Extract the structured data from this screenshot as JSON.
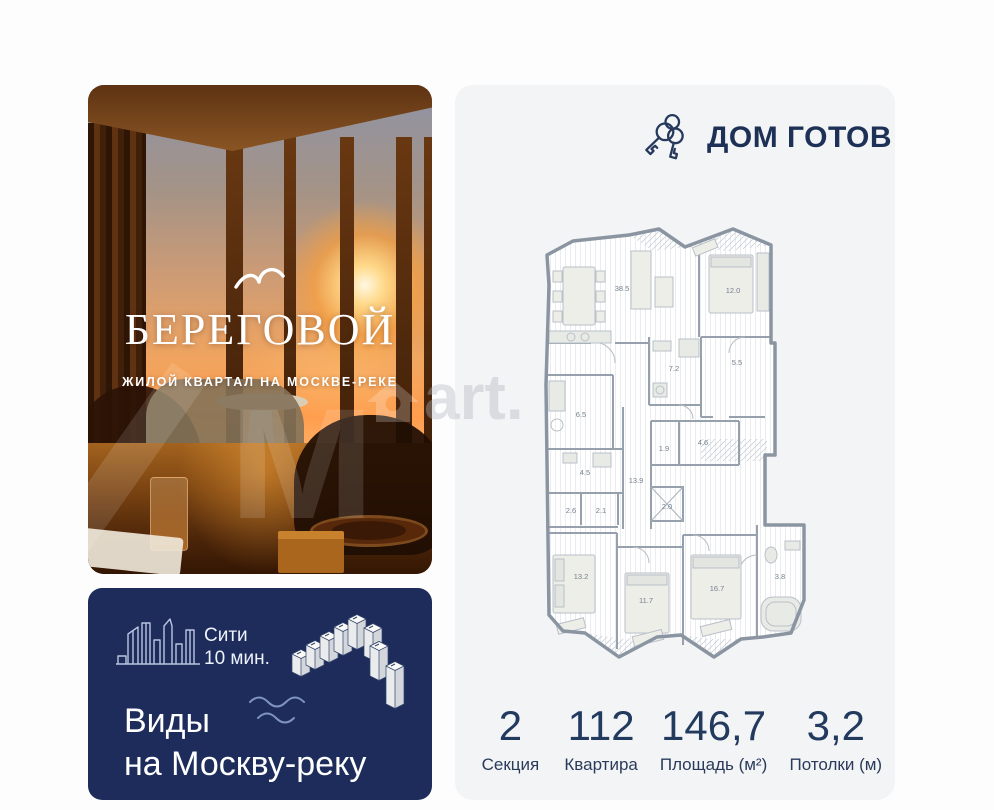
{
  "promo": {
    "brand": "БЕРЕГОВОЙ",
    "tagline": "ЖИЛОЙ КВАРТАЛ НА МОСКВЕ-РЕКЕ",
    "logo_icon": "seagull-icon",
    "scene": "sunset interior with panoramic windows over Moscow river"
  },
  "banner": {
    "background_color": "#1d2c5b",
    "transit_line1": "Сити",
    "transit_line2": "10 мин.",
    "title_line1": "Виды",
    "title_line2": "на Москву-реку",
    "icons": [
      "moscow-city-skyline-icon",
      "riverside-buildings-isometric-icon",
      "river-waves-icon"
    ]
  },
  "status": {
    "label": "ДОМ ГОТОВ",
    "icon": "keys-icon",
    "color": "#1d3156"
  },
  "floor_plan": {
    "type": "apartment-plan",
    "rooms": [
      {
        "name": "kitchen-living",
        "area": "38.5"
      },
      {
        "name": "bedroom-master",
        "area": "12.0"
      },
      {
        "name": "bathroom-1",
        "area": "7.2"
      },
      {
        "name": "hallway",
        "area": "5.5"
      },
      {
        "name": "utility",
        "area": "6.5"
      },
      {
        "name": "wardrobe",
        "area": "4.6"
      },
      {
        "name": "wc",
        "area": "1.9"
      },
      {
        "name": "bathroom-2",
        "area": "4.5"
      },
      {
        "name": "corridor",
        "area": "13.9"
      },
      {
        "name": "closet-1",
        "area": "2.6"
      },
      {
        "name": "closet-2",
        "area": "2.1"
      },
      {
        "name": "shaft-closet",
        "area": "2.0"
      },
      {
        "name": "bedroom-2",
        "area": "13.2"
      },
      {
        "name": "bedroom-3",
        "area": "11.7"
      },
      {
        "name": "bedroom-4",
        "area": "16.7"
      },
      {
        "name": "bathroom-3",
        "area": "3.8"
      }
    ]
  },
  "stats": [
    {
      "value": "2",
      "label": "Секция"
    },
    {
      "value": "112",
      "label": "Квартира"
    },
    {
      "value": "146,7",
      "label": "Площадь (м²)"
    },
    {
      "value": "3,2",
      "label": "Потолки (м)"
    }
  ],
  "watermark": {
    "fragment_left": "м",
    "fragment_right": "art."
  },
  "colors": {
    "card_bg": "#f3f4f6",
    "navy": "#1d2c5b",
    "plan_walls": "#8b95a2"
  }
}
